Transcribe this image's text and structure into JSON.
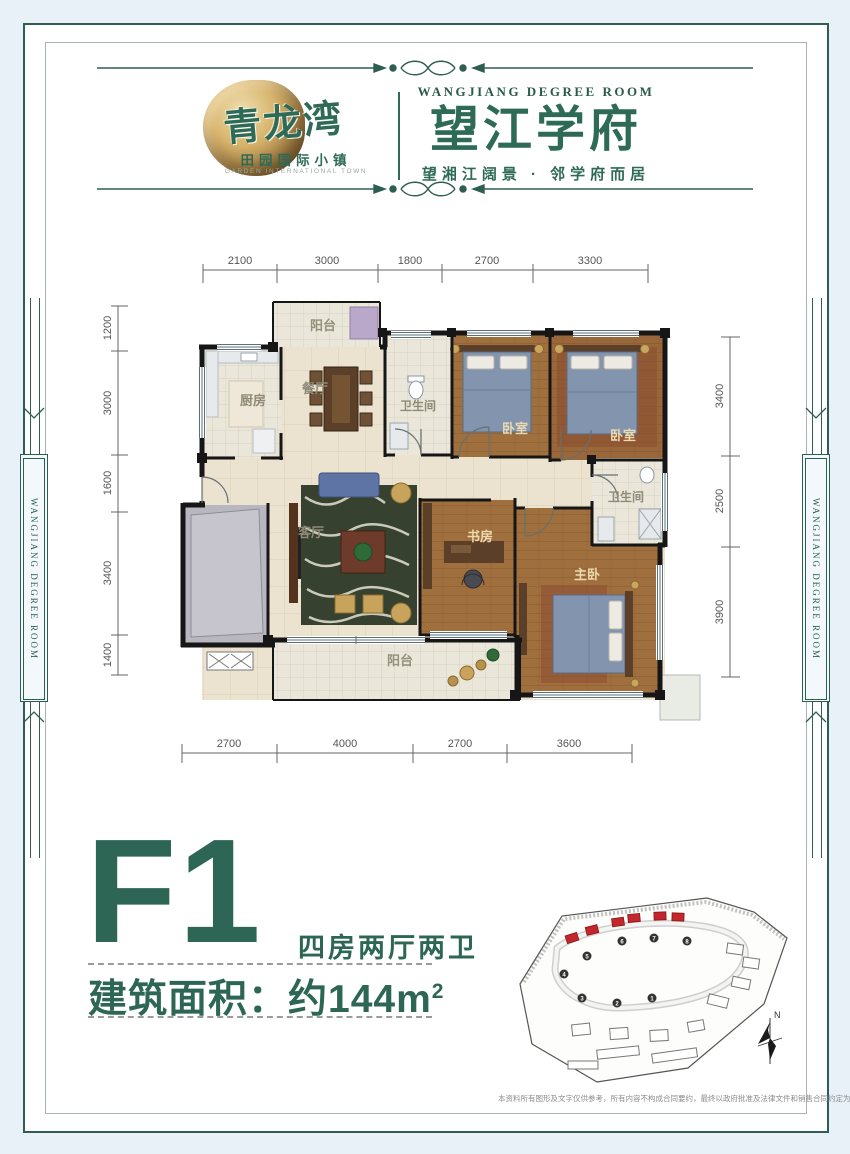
{
  "colors": {
    "brand_green": "#2e6b57",
    "deep_green": "#2d6654",
    "frame_teal": "#2e5e52",
    "site_red": "#c1272d"
  },
  "header": {
    "logo_title": "青龙湾",
    "logo_subtitle": "田园国际小镇",
    "logo_subtitle_en": "GARDEN INTERNATIONAL TOWN",
    "brand_en": "WANGJIANG DEGREE ROOM",
    "brand_cn": "望江学府",
    "brand_tagline": "望湘江阔景 · 邻学府而居"
  },
  "side": {
    "left": "WANGJIANG DEGREE ROOM",
    "right": "WANGJIANG DEGREE ROOM"
  },
  "floor_plan": {
    "dims_top": [
      "2100",
      "3000",
      "1800",
      "2700",
      "3300"
    ],
    "dims_left": [
      "1200",
      "3000",
      "1600",
      "3400",
      "1400"
    ],
    "dims_right": [
      "3400",
      "2500",
      "3900"
    ],
    "dims_bottom": [
      "2700",
      "4000",
      "2700",
      "3600"
    ],
    "rooms": {
      "balcony_top": "阳台",
      "kitchen": "厨房",
      "dining": "餐厅",
      "bath1": "卫生间",
      "bedroom1": "卧室",
      "bedroom2": "卧室",
      "bath2": "卫生间",
      "living": "客厅",
      "study": "书房",
      "master": "主卧",
      "balcony_bottom": "阳台"
    }
  },
  "unit": {
    "code": "F1",
    "type_desc": "四房两厅两卫",
    "area_text": "建筑面积：约144m",
    "area_sup": "2"
  },
  "site_plan": {
    "north": "N",
    "numbers": [
      "1",
      "2",
      "3",
      "4",
      "5",
      "6",
      "7",
      "8"
    ]
  },
  "disclaimer": "本资料所有图形及文字仅供参考，所有内容不构成合同要约，最终以政府批准及法律文件和销售合同约定为准。"
}
